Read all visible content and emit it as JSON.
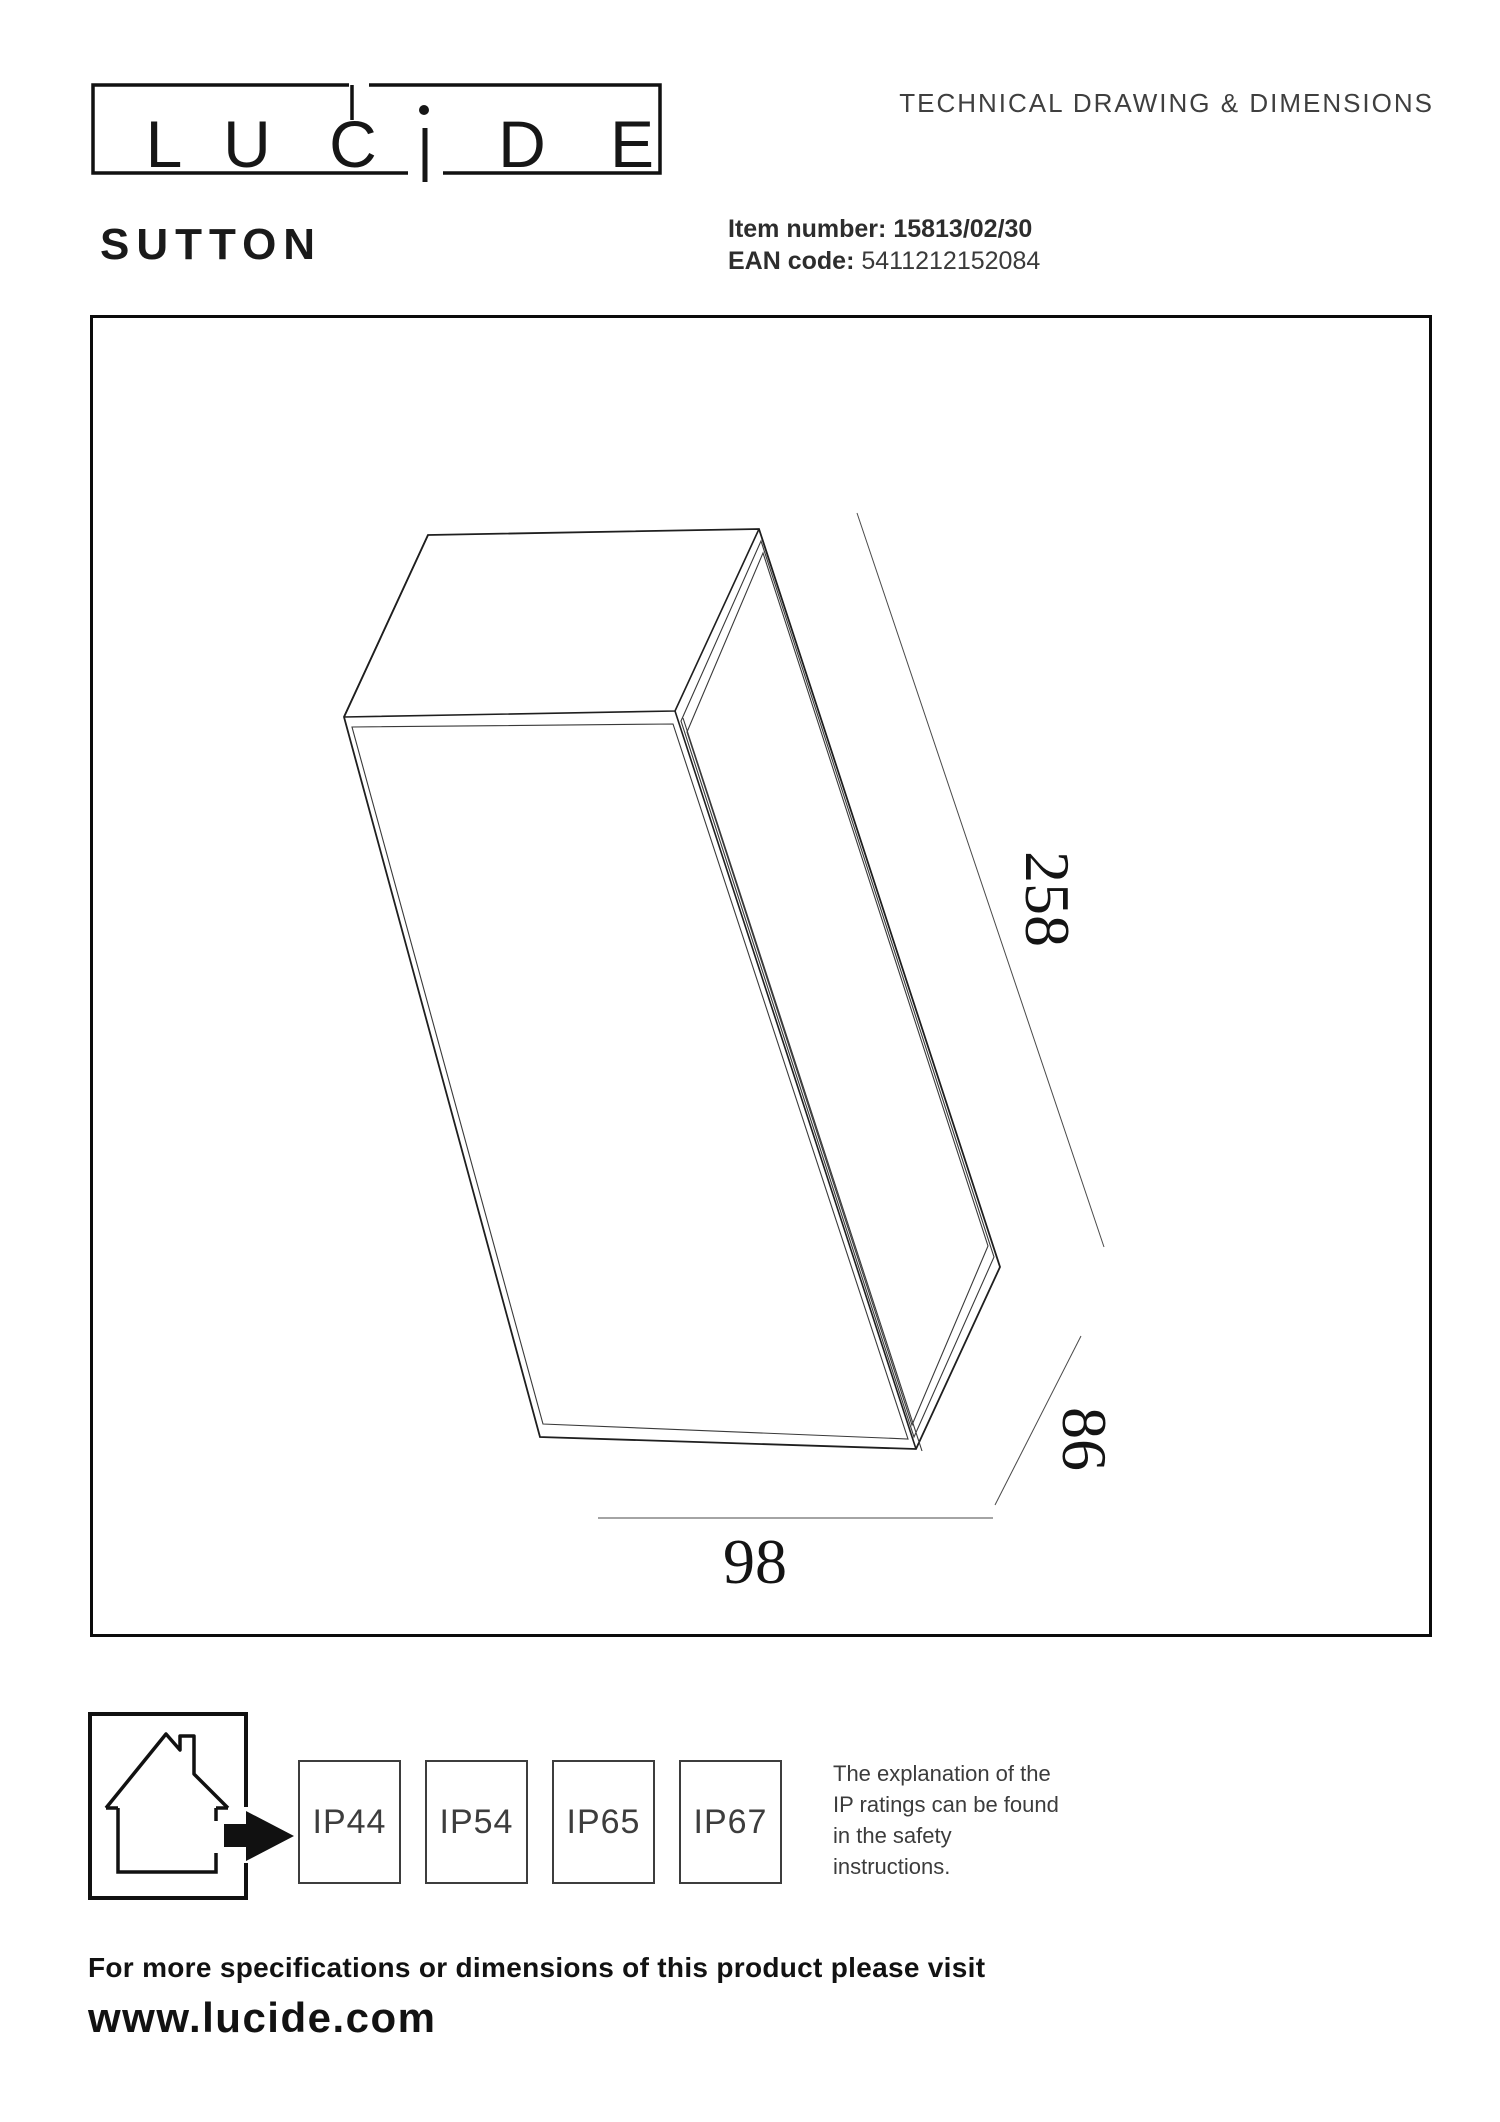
{
  "header": {
    "logo": {
      "brand": "LUCIDE",
      "letters": [
        "L",
        "U",
        "C",
        "D",
        "E"
      ]
    },
    "doc_title": "TECHNICAL DRAWING & DIMENSIONS",
    "product_name": "SUTTON",
    "item_label": "Item number:",
    "item_value": "15813/02/30",
    "ean_label": "EAN code:",
    "ean_value": "5411212152084"
  },
  "drawing": {
    "dim_length": "258",
    "dim_depth": "86",
    "dim_width": "98"
  },
  "footer": {
    "ip_ratings": [
      "IP44",
      "IP54",
      "IP65",
      "IP67"
    ],
    "note_lines": [
      "The explanation of the",
      "IP ratings can be found",
      "in the safety",
      "instructions."
    ],
    "more_info": "For more specifications or dimensions of this product please visit",
    "website": "www.lucide.com"
  },
  "icons": {
    "house": "indoor-use-house-icon",
    "arrow": "arrow-right-icon"
  },
  "colors": {
    "ink": "#111111",
    "drawing_line": "#2a2a2a",
    "muted": "#3d3d3d"
  }
}
